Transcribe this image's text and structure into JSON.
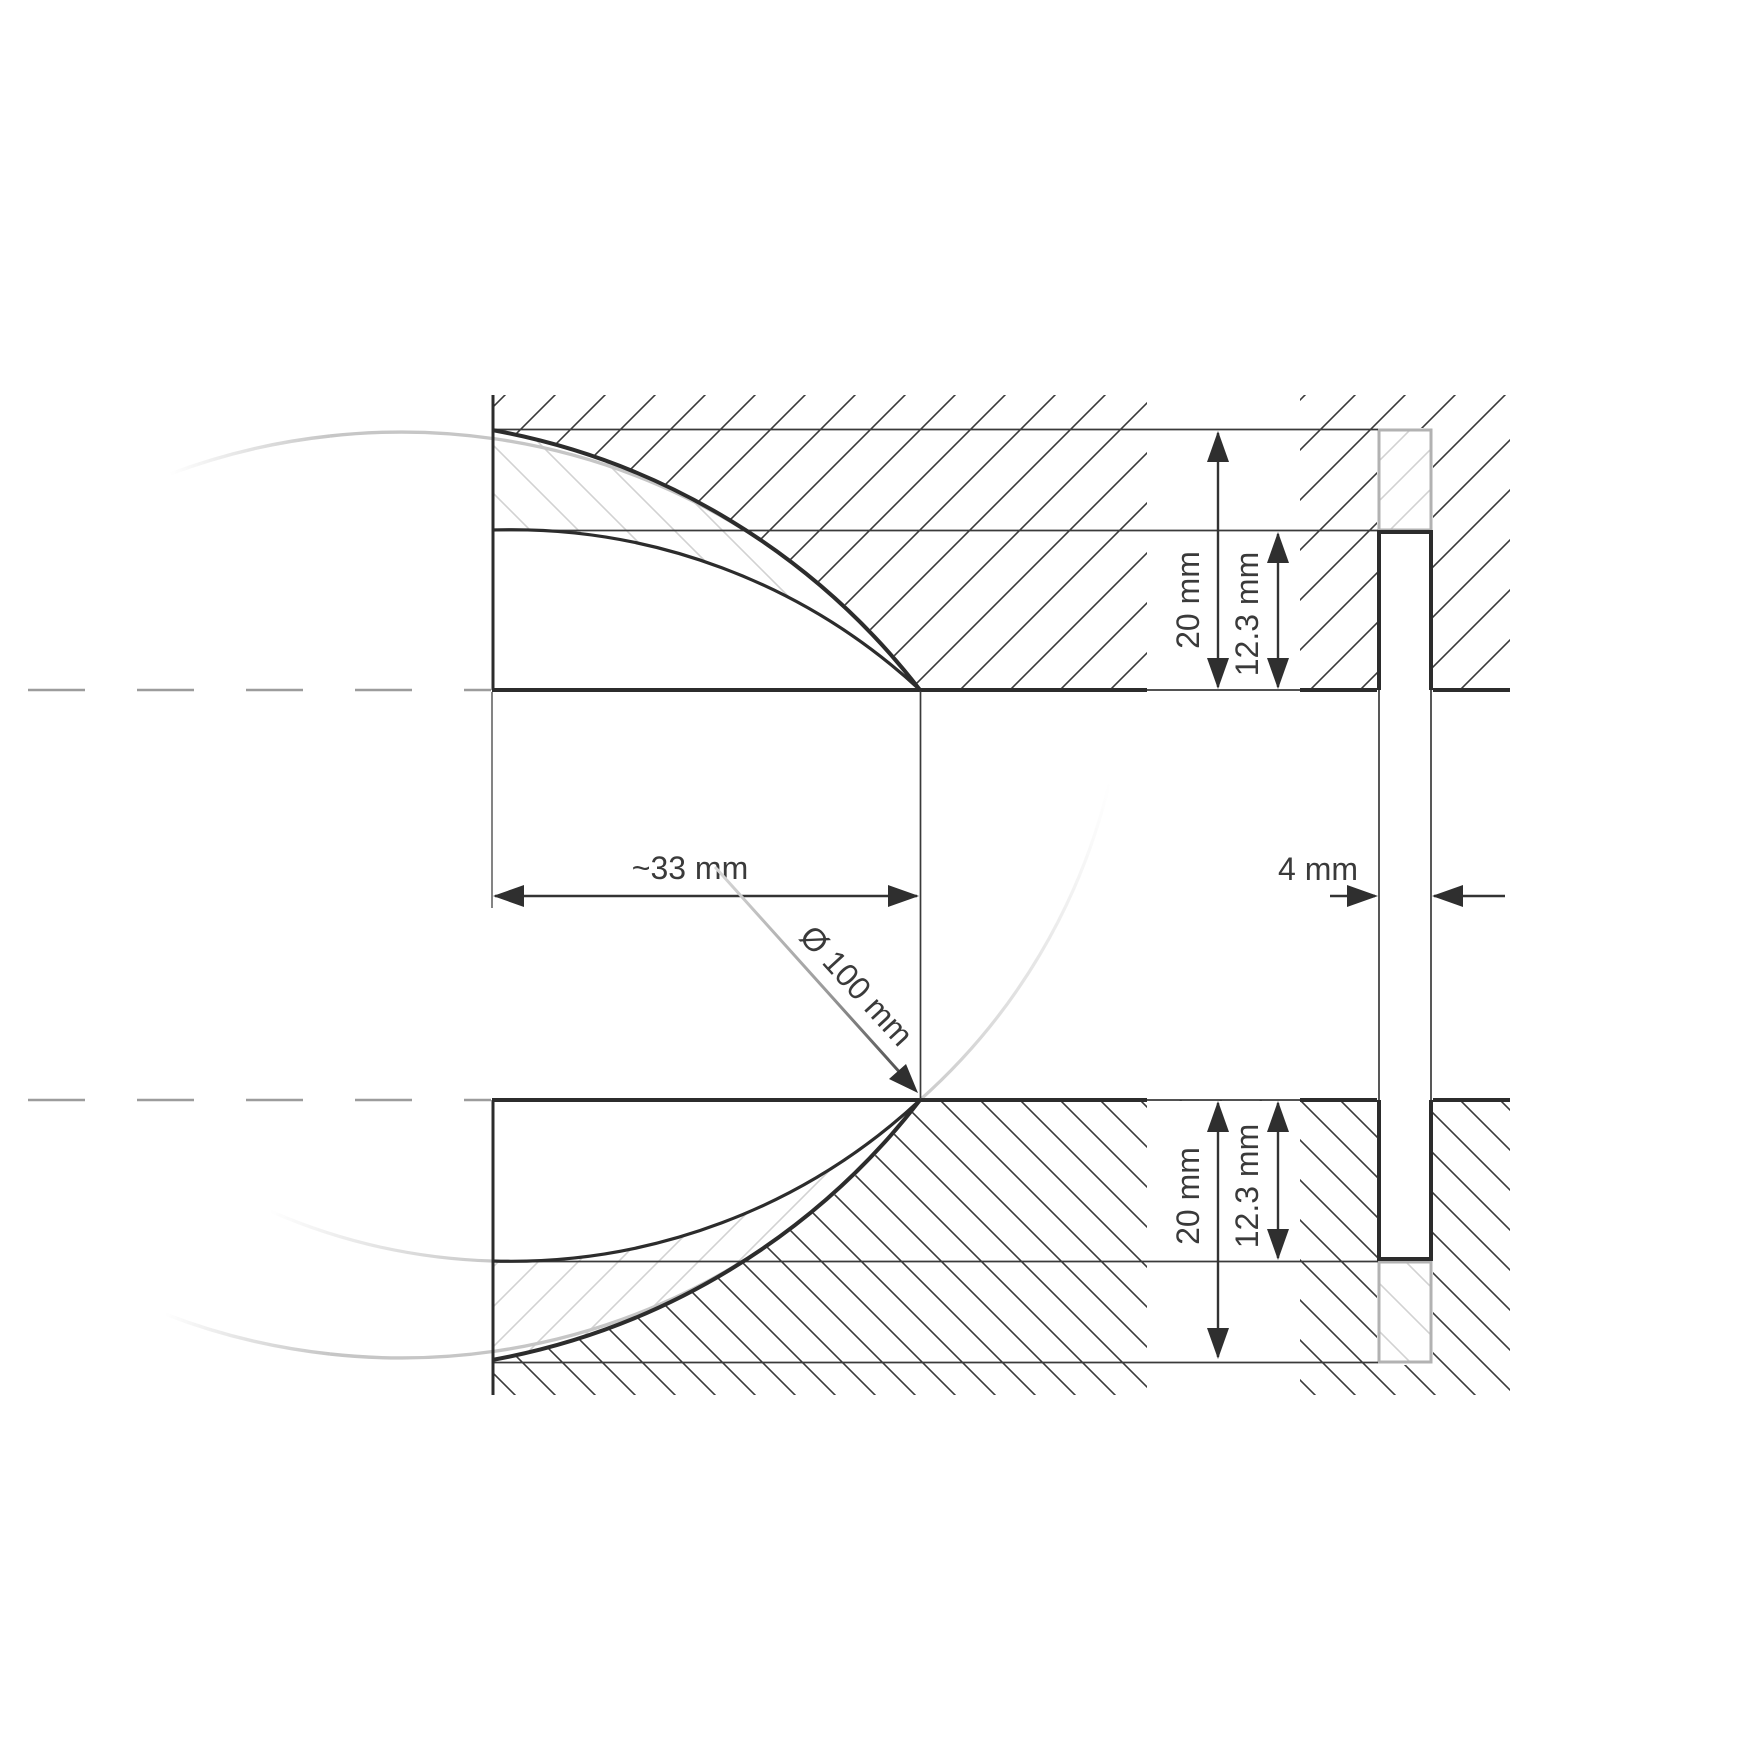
{
  "drawing": {
    "title": "lens-mount-cross-section",
    "labels": {
      "width": "~33 mm",
      "slot_width": "4 mm",
      "lens_diameter": "Ø 100 mm",
      "height_top": "20 mm",
      "depth_top": "12.3 mm",
      "height_bottom": "20 mm",
      "depth_bottom": "12.3 mm"
    },
    "colors": {
      "outline_dark": "#2c2c2c",
      "line_thin": "#3a3a3a",
      "hatch_dark": "#3a3a3a",
      "hatch_light": "#d2d2d2",
      "ghost_gray": "#b2b2b2",
      "arc_gray": "#c6c6c6",
      "centerline_gray": "#9c9c9c",
      "text": "#3a3a3a",
      "background": "#ffffff"
    }
  }
}
